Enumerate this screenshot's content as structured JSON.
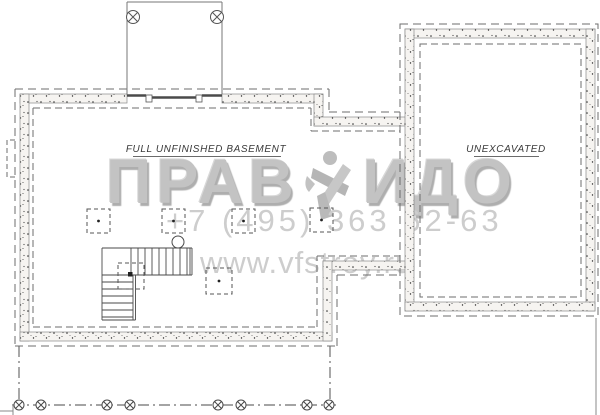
{
  "labels": {
    "basement": "FULL UNFINISHED BASEMENT",
    "unexcavated": "UNEXCAVATED"
  },
  "watermark": {
    "logo_left": "ПРАВ",
    "logo_right": "ИДО",
    "logo_icon": "hammer-and-pick-emblem",
    "phone": "+7 (495) 363 62-63",
    "website": "www.vfstroy.ru"
  },
  "colors": {
    "background": "#ffffff",
    "line": "#4a4a4a",
    "dash": "#6e6e6e",
    "wall_fill": "#f6f4f1",
    "stipple_dot": "#2b2b2b",
    "label_text": "#3a3a3a",
    "watermark_gray": "#c3c3c3",
    "watermark_light": "#cdcdcd"
  }
}
